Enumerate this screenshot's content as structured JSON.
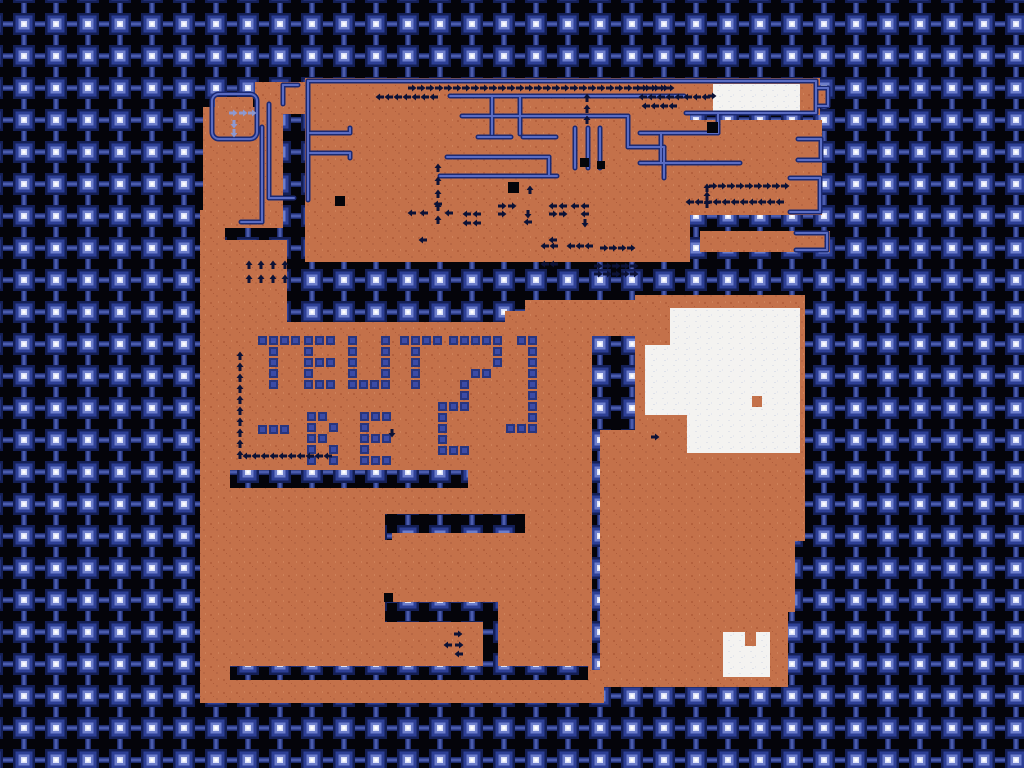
{
  "app": {
    "title": "retro-game-world-map"
  },
  "map_text": {
    "line1": "TEUT",
    "line2": "-RE"
  },
  "colors": {
    "bg": "#04040a",
    "lattice_dark": "#141f55",
    "lattice_mid": "#2d3f95",
    "lattice_light": "#6d7ecb",
    "lattice_core": "#ffffff",
    "lattice_bar": "#1e2c6e",
    "lattice_bar_core": "#4b5cae",
    "orange": "#c4714a",
    "orange_dot": "#b4603c",
    "white": "#f4f3f1",
    "white_dot": "#e2e4ea",
    "wall_dark": "#1b2a74",
    "wall_light": "#5a6cc2",
    "tile_outer": "#28357e",
    "tile_inner": "#3b4ba6",
    "arrow": "#0c1236",
    "arrow_light": "#8e98cf",
    "hole": "#05050a"
  },
  "map": {
    "orange_rects": [
      [
        305,
        78,
        385,
        184
      ],
      [
        690,
        78,
        130,
        37
      ],
      [
        818,
        86,
        12,
        22
      ],
      [
        640,
        120,
        182,
        54
      ],
      [
        640,
        174,
        182,
        41
      ],
      [
        700,
        231,
        130,
        21
      ],
      [
        255,
        82,
        52,
        32
      ],
      [
        215,
        97,
        38,
        38
      ],
      [
        203,
        107,
        80,
        121
      ],
      [
        200,
        210,
        25,
        131
      ],
      [
        225,
        240,
        62,
        100
      ],
      [
        200,
        322,
        392,
        381
      ],
      [
        505,
        311,
        87,
        12
      ],
      [
        525,
        300,
        67,
        12
      ],
      [
        592,
        300,
        43,
        36
      ],
      [
        635,
        295,
        170,
        136
      ],
      [
        600,
        430,
        205,
        111
      ],
      [
        600,
        540,
        195,
        72
      ],
      [
        600,
        611,
        188,
        76
      ],
      [
        590,
        670,
        14,
        33
      ]
    ],
    "slot_rects": [
      [
        230,
        470,
        238,
        18
      ],
      [
        385,
        514,
        140,
        19
      ],
      [
        385,
        528,
        7,
        12
      ],
      [
        385,
        602,
        113,
        20
      ],
      [
        483,
        613,
        15,
        60
      ],
      [
        230,
        666,
        358,
        14
      ]
    ],
    "white_rects": [
      [
        713,
        84,
        87,
        27
      ],
      [
        670,
        308,
        130,
        38
      ],
      [
        645,
        345,
        155,
        70
      ],
      [
        687,
        415,
        113,
        38
      ],
      [
        723,
        632,
        47,
        45
      ]
    ],
    "white_patches_orange": [
      [
        745,
        632,
        11,
        14
      ],
      [
        752,
        396,
        10,
        11
      ]
    ],
    "dark_squares": [
      [
        707,
        122,
        11,
        11
      ],
      [
        508,
        182,
        11,
        11
      ],
      [
        580,
        158,
        9,
        9
      ],
      [
        597,
        161,
        8,
        8
      ],
      [
        335,
        196,
        10,
        10
      ],
      [
        384,
        593,
        9,
        9
      ]
    ],
    "box_outline": {
      "x": 212,
      "y": 94,
      "w": 45,
      "h": 45,
      "r": 7
    },
    "walls": [
      [
        308,
        81,
        816,
        81
      ],
      [
        818,
        88,
        828,
        88
      ],
      [
        828,
        88,
        828,
        106
      ],
      [
        828,
        106,
        818,
        106
      ],
      [
        816,
        81,
        816,
        113
      ],
      [
        686,
        113,
        816,
        113
      ],
      [
        308,
        81,
        308,
        200
      ],
      [
        310,
        133,
        350,
        133
      ],
      [
        350,
        133,
        350,
        128
      ],
      [
        310,
        153,
        350,
        153
      ],
      [
        350,
        153,
        350,
        158
      ],
      [
        450,
        96,
        684,
        96
      ],
      [
        462,
        116,
        628,
        116
      ],
      [
        628,
        116,
        628,
        147
      ],
      [
        628,
        147,
        664,
        147
      ],
      [
        664,
        147,
        664,
        178
      ],
      [
        492,
        96,
        492,
        134
      ],
      [
        520,
        96,
        520,
        134
      ],
      [
        478,
        137,
        511,
        137
      ],
      [
        523,
        137,
        556,
        137
      ],
      [
        447,
        157,
        549,
        157
      ],
      [
        549,
        157,
        549,
        175
      ],
      [
        440,
        176,
        557,
        176
      ],
      [
        575,
        128,
        575,
        168
      ],
      [
        588,
        128,
        588,
        168
      ],
      [
        600,
        128,
        600,
        168
      ],
      [
        640,
        133,
        718,
        133
      ],
      [
        718,
        113,
        718,
        133
      ],
      [
        661,
        134,
        661,
        163
      ],
      [
        640,
        163,
        740,
        163
      ],
      [
        798,
        139,
        821,
        139
      ],
      [
        821,
        139,
        821,
        160
      ],
      [
        821,
        160,
        798,
        160
      ],
      [
        790,
        178,
        820,
        178
      ],
      [
        820,
        178,
        820,
        212
      ],
      [
        820,
        212,
        790,
        212
      ],
      [
        796,
        233,
        827,
        233
      ],
      [
        827,
        233,
        827,
        250
      ],
      [
        827,
        250,
        796,
        250
      ],
      [
        269,
        104,
        269,
        198
      ],
      [
        269,
        198,
        294,
        198
      ],
      [
        262,
        127,
        262,
        222
      ],
      [
        262,
        222,
        241,
        222
      ],
      [
        283,
        85,
        283,
        104
      ],
      [
        283,
        85,
        298,
        85
      ]
    ],
    "letters": [
      {
        "g": "T",
        "x": 258,
        "y": 336
      },
      {
        "g": "E",
        "x": 304,
        "y": 336
      },
      {
        "g": "U",
        "x": 348,
        "y": 336
      },
      {
        "g": "T",
        "x": 400,
        "y": 336
      },
      {
        "g": "2",
        "x": 438,
        "y": 336
      },
      {
        "g": "]",
        "x": 506,
        "y": 336
      },
      {
        "g": "-",
        "x": 258,
        "y": 425
      },
      {
        "g": "R",
        "x": 307,
        "y": 412
      },
      {
        "g": "E",
        "x": 360,
        "y": 412
      }
    ],
    "font": {
      "T": [
        "XXXX",
        ".X..",
        ".X..",
        ".X..",
        ".X.."
      ],
      "E": [
        "XXX",
        "X..",
        "XXX",
        "X..",
        "XXX"
      ],
      "U": [
        "X..X",
        "X..X",
        "X..X",
        "X..X",
        "XXXX"
      ],
      "R": [
        "XX.",
        "X.X",
        "XX.",
        "X.X",
        "X.X"
      ],
      "-": [
        "XXX"
      ],
      "2": [
        ".XXXXX",
        ".....X",
        ".....X",
        "...XX.",
        "..X...",
        "..X...",
        "XXX...",
        "X.....",
        "X.....",
        "X.....",
        "XXX..."
      ],
      "]": [
        ".XX",
        "..X",
        "..X",
        "..X",
        "..X",
        "..X",
        "..X",
        "..X",
        "XXX"
      ]
    },
    "tile_pitch": 11,
    "tile_size": 9,
    "arrow_runs": [
      {
        "x": 412,
        "y": 88,
        "dx": 9,
        "dy": 0,
        "n": 29,
        "dir": "R"
      },
      {
        "x": 380,
        "y": 97,
        "dx": 9,
        "dy": 0,
        "n": 7,
        "dir": "L"
      },
      {
        "x": 438,
        "y": 220,
        "dx": 0,
        "dy": -13,
        "n": 5,
        "dir": "U"
      },
      {
        "x": 643,
        "y": 88,
        "dx": 9,
        "dy": 0,
        "n": 4,
        "dir": "R"
      },
      {
        "x": 643,
        "y": 97,
        "dx": 9,
        "dy": 0,
        "n": 8,
        "dir": "L"
      },
      {
        "x": 646,
        "y": 106,
        "dx": 9,
        "dy": 0,
        "n": 4,
        "dir": "L"
      },
      {
        "x": 713,
        "y": 186,
        "dx": 9,
        "dy": 0,
        "n": 9,
        "dir": "R"
      },
      {
        "x": 690,
        "y": 202,
        "dx": 9,
        "dy": 0,
        "n": 11,
        "dir": "L"
      },
      {
        "x": 707,
        "y": 204,
        "dx": 0,
        "dy": -8,
        "n": 3,
        "dir": "U"
      },
      {
        "x": 587,
        "y": 120,
        "dx": 0,
        "dy": -11,
        "n": 3,
        "dir": "U"
      },
      {
        "x": 545,
        "y": 246,
        "dx": 9,
        "dy": 0,
        "n": 2,
        "dir": "L"
      },
      {
        "x": 571,
        "y": 246,
        "dx": 9,
        "dy": 0,
        "n": 3,
        "dir": "L"
      },
      {
        "x": 604,
        "y": 248,
        "dx": 9,
        "dy": 0,
        "n": 4,
        "dir": "R"
      },
      {
        "x": 545,
        "y": 264,
        "dx": 9,
        "dy": 0,
        "n": 2,
        "dir": "L"
      },
      {
        "x": 598,
        "y": 266,
        "dx": 9,
        "dy": 0,
        "n": 5,
        "dir": "R"
      },
      {
        "x": 598,
        "y": 274,
        "dx": 9,
        "dy": 0,
        "n": 5,
        "dir": "R"
      },
      {
        "x": 240,
        "y": 455,
        "dx": 0,
        "dy": -11,
        "n": 10,
        "dir": "U"
      },
      {
        "x": 247,
        "y": 456,
        "dx": 9,
        "dy": 0,
        "n": 10,
        "dir": "L"
      },
      {
        "x": 249,
        "y": 265,
        "dx": 12,
        "dy": 0,
        "n": 4,
        "dir": "U"
      },
      {
        "x": 249,
        "y": 279,
        "dx": 12,
        "dy": 0,
        "n": 4,
        "dir": "U"
      }
    ],
    "arrow_singles": [
      [
        412,
        213,
        "L"
      ],
      [
        424,
        213,
        "L"
      ],
      [
        438,
        204,
        "L"
      ],
      [
        449,
        213,
        "L"
      ],
      [
        467,
        214,
        "L"
      ],
      [
        477,
        214,
        "L"
      ],
      [
        467,
        223,
        "L"
      ],
      [
        477,
        223,
        "L"
      ],
      [
        502,
        206,
        "R"
      ],
      [
        512,
        206,
        "R"
      ],
      [
        502,
        214,
        "R"
      ],
      [
        530,
        190,
        "U"
      ],
      [
        528,
        214,
        "D"
      ],
      [
        528,
        222,
        "L"
      ],
      [
        553,
        206,
        "L"
      ],
      [
        563,
        206,
        "L"
      ],
      [
        553,
        214,
        "R"
      ],
      [
        563,
        214,
        "R"
      ],
      [
        575,
        206,
        "L"
      ],
      [
        585,
        206,
        "L"
      ],
      [
        585,
        214,
        "L"
      ],
      [
        585,
        223,
        "D"
      ],
      [
        423,
        240,
        "L"
      ],
      [
        553,
        240,
        "L"
      ],
      [
        712,
        96,
        "R"
      ],
      [
        655,
        437,
        "R"
      ],
      [
        392,
        433,
        "D"
      ],
      [
        458,
        634,
        "R"
      ],
      [
        448,
        645,
        "L"
      ],
      [
        459,
        645,
        "R"
      ],
      [
        459,
        654,
        "L"
      ]
    ],
    "arrow_singles_light": [
      [
        233,
        113,
        "R"
      ],
      [
        243,
        113,
        "R"
      ],
      [
        252,
        113,
        "R"
      ],
      [
        234,
        124,
        "D"
      ],
      [
        234,
        133,
        "D"
      ]
    ]
  }
}
